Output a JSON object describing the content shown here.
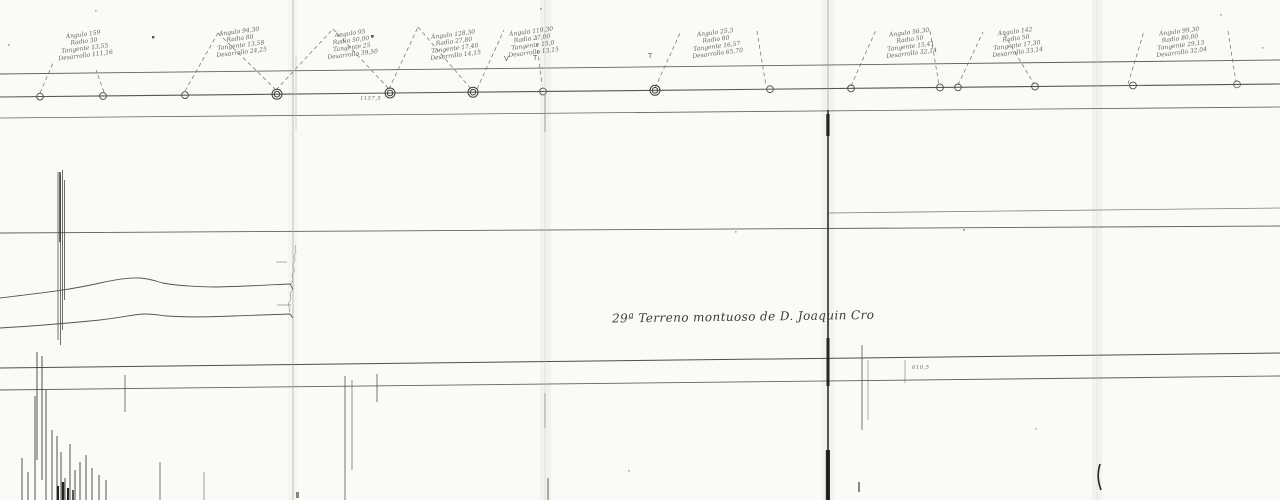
{
  "page": {
    "title": "29ª Terreno montuoso de D. Joaquin Cro",
    "kind": "scanned-survey-plan"
  },
  "annotations": {
    "station_note": "1157,5",
    "elevation_note": "610,5",
    "tick_v": "V",
    "tick_t1": "T",
    "tick_t2": "T"
  },
  "curve_labels": [
    {
      "lines": [
        "Ángulo 159",
        "Radio 30",
        "Tangente 13,55",
        "Desarrollo 111,16"
      ]
    },
    {
      "lines": [
        "Ángulo 94,30",
        "Radio 80",
        "Tangente 13,58",
        "Desarrollo 24,25"
      ]
    },
    {
      "lines": [
        "Ángulo 95",
        "Radio 50,00",
        "Tangente 25",
        "Desarrollo 39,50"
      ]
    },
    {
      "lines": [
        "Ángulo 128,30",
        "Radio 27,80",
        "Tangente 17,40",
        "Desarrollo 14,15"
      ]
    },
    {
      "lines": [
        "Ángulo 119,30",
        "Radio 27,00",
        "Tangente 15,0",
        "Desarrollo 13,15"
      ]
    },
    {
      "lines": [
        "Ángulo 25,3",
        "Radio 80",
        "Tangente 16,57",
        "Desarrollo 65,70"
      ]
    },
    {
      "lines": [
        "Ángulo 56,30",
        "Radio 50",
        "Tangente 15,41",
        "Desarrollo 32,14"
      ]
    },
    {
      "lines": [
        "Ángulo 142",
        "Radio 50",
        "Tangente 17,30",
        "Desarrollo 33,14"
      ]
    },
    {
      "lines": [
        "Ángulo 99,30",
        "Radio 80,00",
        "Tangente 29,13",
        "Desarrollo 32,04"
      ]
    }
  ],
  "colors": {
    "paper": "#fafaf7",
    "ink": "#55554e",
    "fold_dark": "#1c1c1a"
  }
}
